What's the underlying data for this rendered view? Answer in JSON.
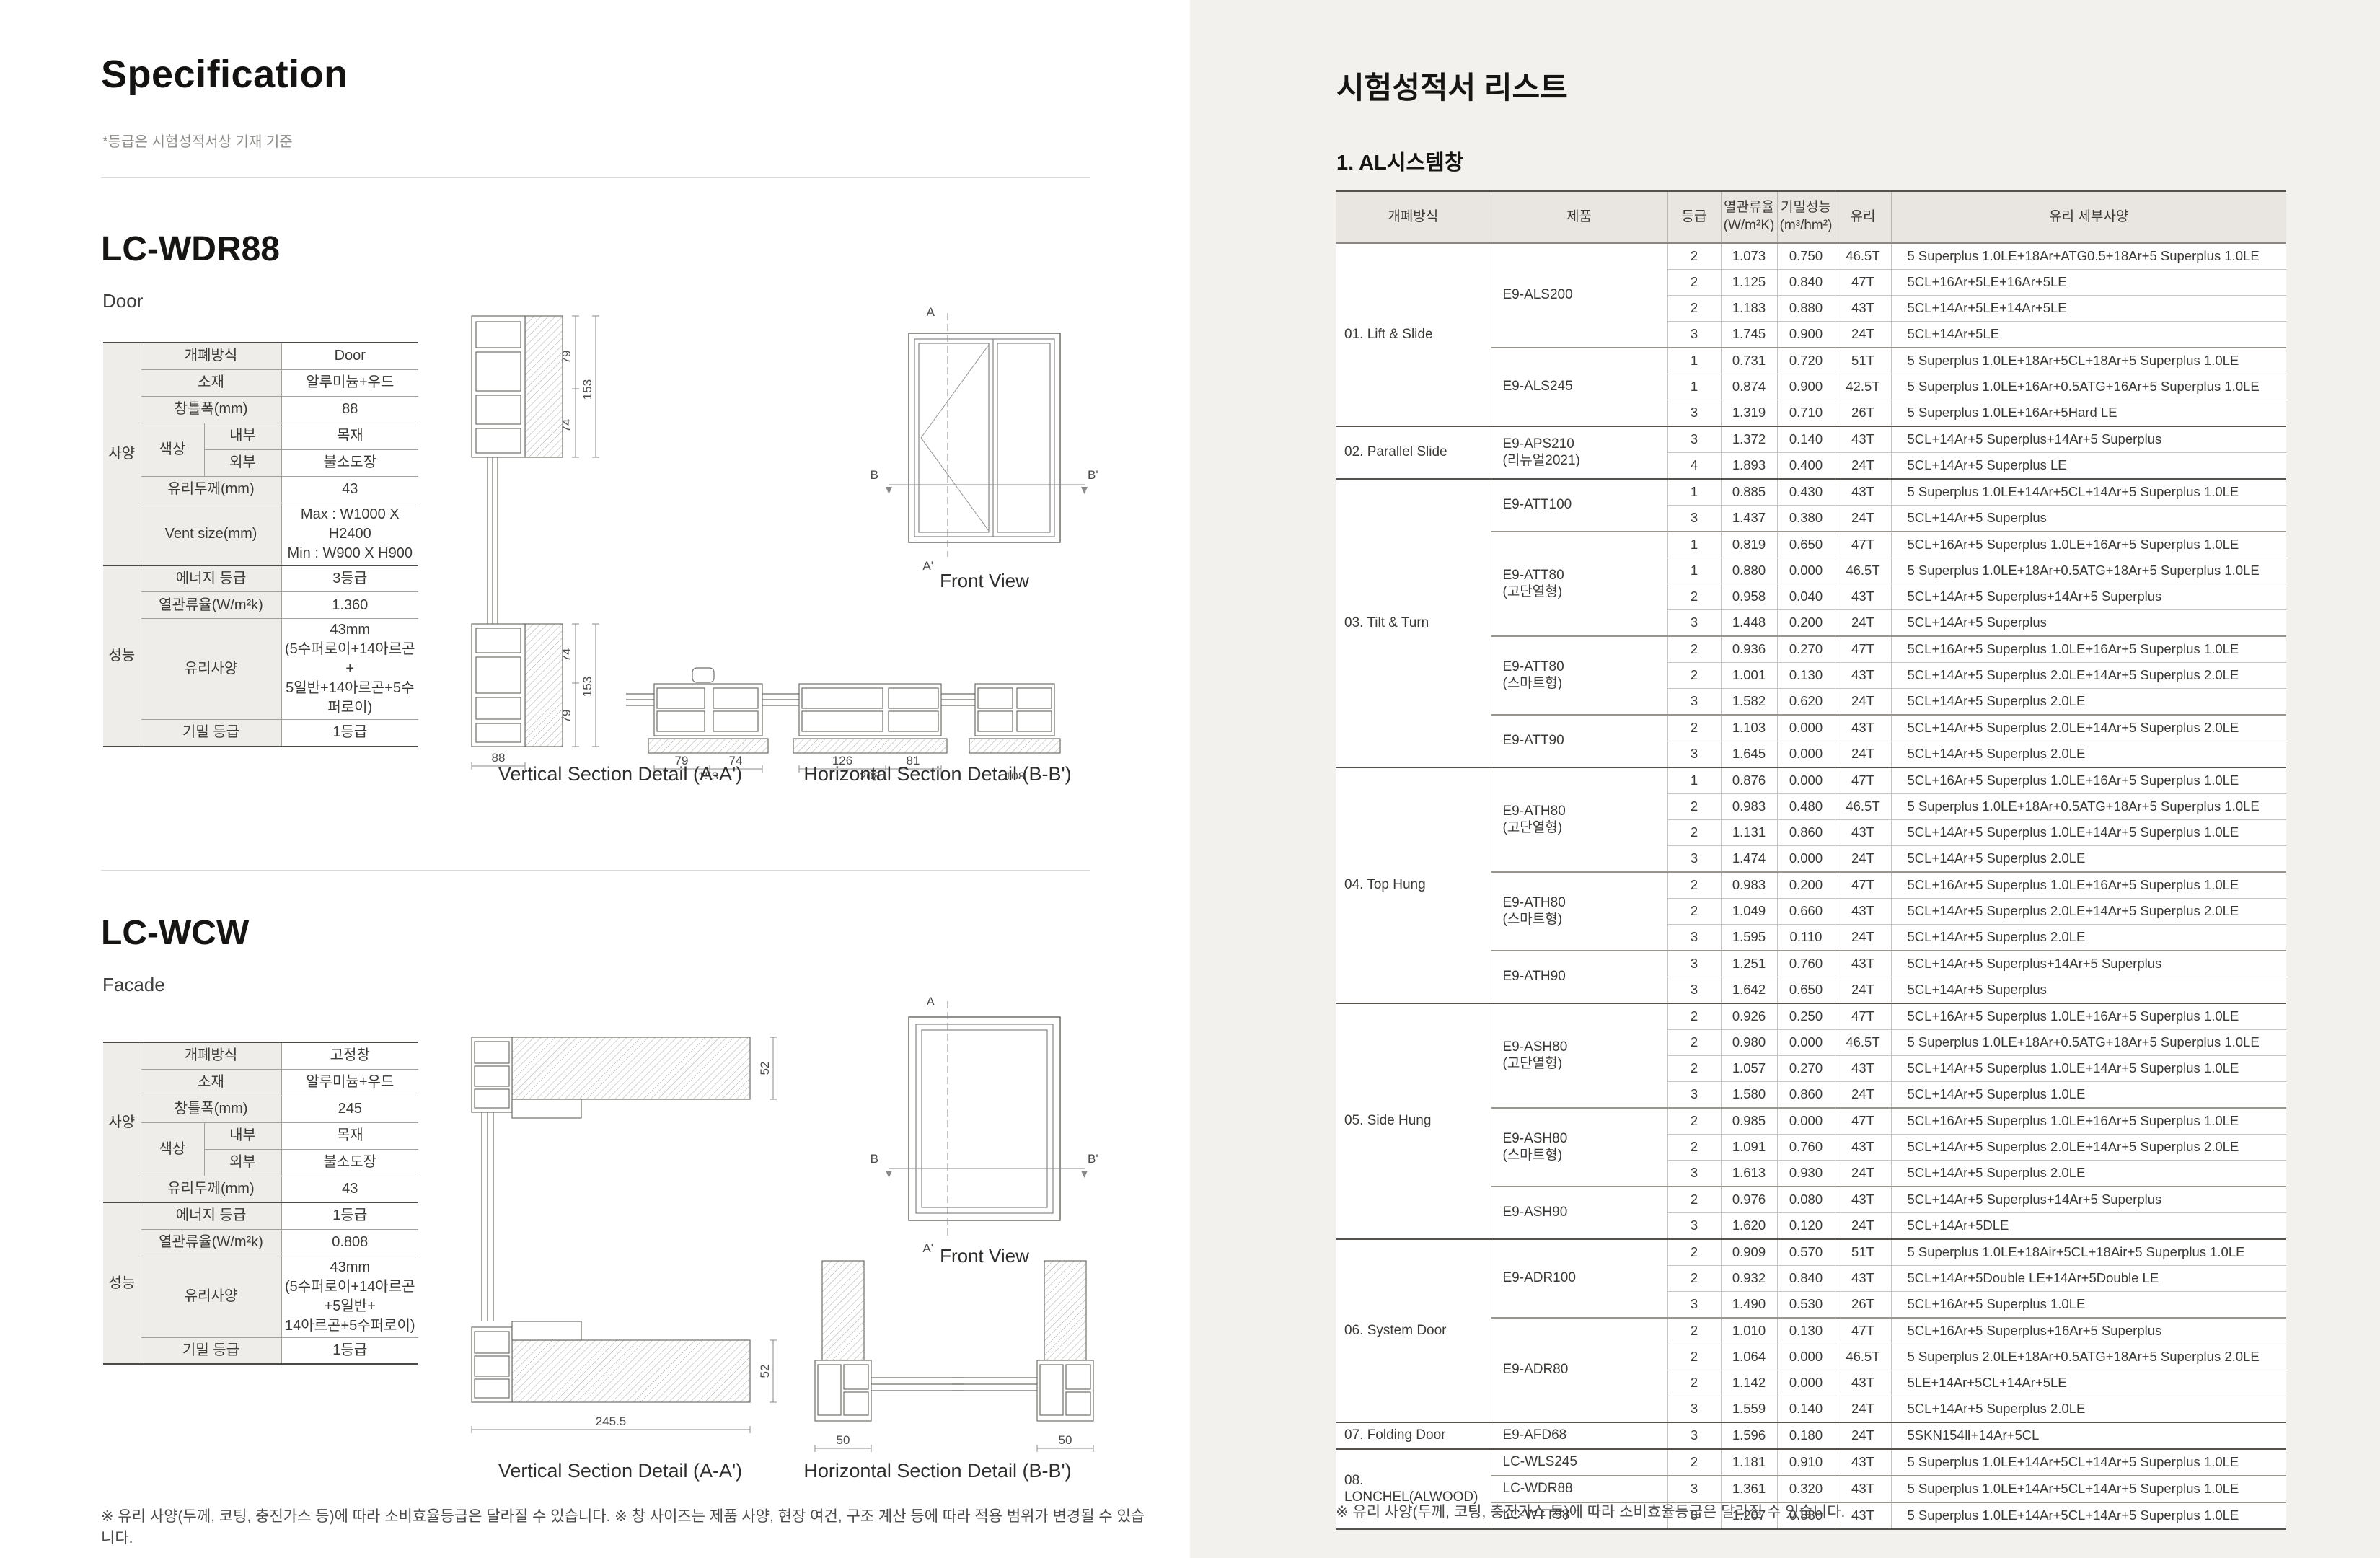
{
  "colors": {
    "right_panel_bg": "#f2f1ed",
    "table_header_bg": "#e9e6e2",
    "label_cell_bg": "#efedea"
  },
  "left": {
    "title": "Specification",
    "note": "*등급은 시험성적서상 기재 기준",
    "footnote": "※ 유리 사양(두께, 코팅, 충진가스 등)에 따라 소비효율등급은 달라질 수 있습니다.  ※ 창 사이즈는 제품 사양, 현장 여건, 구조 계산 등에 따라 적용 범위가 변경될 수 있습니다.",
    "products": [
      {
        "model": "LC-WDR88",
        "type": "Door",
        "spec": {
          "groups": [
            {
              "name": "사양",
              "rows": [
                {
                  "label": "개폐방식",
                  "value": "Door"
                },
                {
                  "label": "소재",
                  "value": "알루미늄+우드"
                },
                {
                  "label": "창틀폭(mm)",
                  "value": "88"
                },
                {
                  "label": "색상",
                  "subrows": [
                    {
                      "sub": "내부",
                      "value": "목재"
                    },
                    {
                      "sub": "외부",
                      "value": "불소도장"
                    }
                  ]
                },
                {
                  "label": "유리두께(mm)",
                  "value": "43"
                },
                {
                  "label": "Vent size(mm)",
                  "value_lines": [
                    "Max : W1000 X H2400",
                    "Min : W900 X H900"
                  ]
                }
              ]
            },
            {
              "name": "성능",
              "rows": [
                {
                  "label": "에너지 등급",
                  "value": "3등급"
                },
                {
                  "label": "열관류율(W/m²k)",
                  "value": "1.360"
                },
                {
                  "label": "유리사양",
                  "value_lines": [
                    "43mm",
                    "(5수퍼로이+14아르곤+",
                    "5일반+14아르곤+5수퍼로이)"
                  ]
                },
                {
                  "label": "기밀 등급",
                  "value": "1등급"
                }
              ]
            }
          ]
        },
        "drawings": {
          "vertical_caption": "Vertical Section Detail (A-A')",
          "horizontal_caption": "Horizontal Section Detail (B-B')",
          "front_caption": "Front View",
          "axis_labels": [
            "A",
            "A'",
            "B",
            "B'"
          ],
          "v_top_dims": [
            "79",
            "74",
            "153"
          ],
          "v_bottom_dims": [
            "74",
            "79",
            "153",
            "88"
          ],
          "h_dims": [
            [
              "79",
              "74",
              "153"
            ],
            [
              "126",
              "81",
              "208"
            ],
            [
              "108"
            ]
          ]
        }
      },
      {
        "model": "LC-WCW",
        "type": "Facade",
        "spec": {
          "groups": [
            {
              "name": "사양",
              "rows": [
                {
                  "label": "개폐방식",
                  "value": "고정창"
                },
                {
                  "label": "소재",
                  "value": "알루미늄+우드"
                },
                {
                  "label": "창틀폭(mm)",
                  "value": "245"
                },
                {
                  "label": "색상",
                  "subrows": [
                    {
                      "sub": "내부",
                      "value": "목재"
                    },
                    {
                      "sub": "외부",
                      "value": "불소도장"
                    }
                  ]
                },
                {
                  "label": "유리두께(mm)",
                  "value": "43"
                }
              ]
            },
            {
              "name": "성능",
              "rows": [
                {
                  "label": "에너지 등급",
                  "value": "1등급"
                },
                {
                  "label": "열관류율(W/m²k)",
                  "value": "0.808"
                },
                {
                  "label": "유리사양",
                  "value_lines": [
                    "43mm",
                    "(5수퍼로이+14아르곤+5일반+",
                    "14아르곤+5수퍼로이)"
                  ]
                },
                {
                  "label": "기밀 등급",
                  "value": "1등급"
                }
              ]
            }
          ]
        },
        "drawings": {
          "vertical_caption": "Vertical Section Detail (A-A')",
          "horizontal_caption": "Horizontal Section Detail (B-B')",
          "front_caption": "Front View",
          "axis_labels": [
            "A",
            "A'",
            "B",
            "B'"
          ],
          "v_top_dims": [
            "52"
          ],
          "v_bottom_dims": [
            "52",
            "245.5"
          ],
          "h_dims": [
            [
              "50"
            ],
            [
              "50"
            ]
          ]
        }
      }
    ]
  },
  "right": {
    "title": "시험성적서 리스트",
    "section": "1. AL시스템창",
    "footnote": "※ 유리 사양(두께, 코팅, 충진가스 등)에 따라 소비효율등급은 달라질 수 있습니다.",
    "table": {
      "headers": [
        "개폐방식",
        "제품",
        "등급",
        "열관류율\n(W/m²K)",
        "기밀성능\n(m³/hm²)",
        "유리",
        "유리 세부사양"
      ],
      "groups": [
        {
          "name": "01. Lift & Slide",
          "products": [
            {
              "name": "E9-ALS200",
              "rows": [
                [
                  "2",
                  "1.073",
                  "0.750",
                  "46.5T",
                  "5 Superplus 1.0LE+18Ar+ATG0.5+18Ar+5 Superplus 1.0LE"
                ],
                [
                  "2",
                  "1.125",
                  "0.840",
                  "47T",
                  "5CL+16Ar+5LE+16Ar+5LE"
                ],
                [
                  "2",
                  "1.183",
                  "0.880",
                  "43T",
                  "5CL+14Ar+5LE+14Ar+5LE"
                ],
                [
                  "3",
                  "1.745",
                  "0.900",
                  "24T",
                  "5CL+14Ar+5LE"
                ]
              ]
            },
            {
              "name": "E9-ALS245",
              "rows": [
                [
                  "1",
                  "0.731",
                  "0.720",
                  "51T",
                  "5 Superplus 1.0LE+18Ar+5CL+18Ar+5 Superplus 1.0LE"
                ],
                [
                  "1",
                  "0.874",
                  "0.900",
                  "42.5T",
                  "5 Superplus 1.0LE+16Ar+0.5ATG+16Ar+5 Superplus 1.0LE"
                ],
                [
                  "3",
                  "1.319",
                  "0.710",
                  "26T",
                  "5 Superplus 1.0LE+16Ar+5Hard LE"
                ]
              ]
            }
          ]
        },
        {
          "name": "02. Parallel Slide",
          "products": [
            {
              "name": "E9-APS210",
              "name2": "(리뉴얼2021)",
              "rows": [
                [
                  "3",
                  "1.372",
                  "0.140",
                  "43T",
                  "5CL+14Ar+5 Superplus+14Ar+5 Superplus"
                ],
                [
                  "4",
                  "1.893",
                  "0.400",
                  "24T",
                  "5CL+14Ar+5 Superplus LE"
                ]
              ]
            }
          ]
        },
        {
          "name": "03. Tilt & Turn",
          "products": [
            {
              "name": "E9-ATT100",
              "rows": [
                [
                  "1",
                  "0.885",
                  "0.430",
                  "43T",
                  "5 Superplus 1.0LE+14Ar+5CL+14Ar+5 Superplus 1.0LE"
                ],
                [
                  "3",
                  "1.437",
                  "0.380",
                  "24T",
                  "5CL+14Ar+5 Superplus"
                ]
              ]
            },
            {
              "name": "E9-ATT80",
              "name2": "(고단열형)",
              "rows": [
                [
                  "1",
                  "0.819",
                  "0.650",
                  "47T",
                  "5CL+16Ar+5 Superplus 1.0LE+16Ar+5 Superplus 1.0LE"
                ],
                [
                  "1",
                  "0.880",
                  "0.000",
                  "46.5T",
                  "5 Superplus 1.0LE+18Ar+0.5ATG+18Ar+5 Superplus 1.0LE"
                ],
                [
                  "2",
                  "0.958",
                  "0.040",
                  "43T",
                  "5CL+14Ar+5 Superplus+14Ar+5 Superplus"
                ],
                [
                  "3",
                  "1.448",
                  "0.200",
                  "24T",
                  "5CL+14Ar+5 Superplus"
                ]
              ]
            },
            {
              "name": "E9-ATT80",
              "name2": "(스마트형)",
              "rows": [
                [
                  "2",
                  "0.936",
                  "0.270",
                  "47T",
                  "5CL+16Ar+5 Superplus 1.0LE+16Ar+5 Superplus 1.0LE"
                ],
                [
                  "2",
                  "1.001",
                  "0.130",
                  "43T",
                  "5CL+14Ar+5 Superplus 2.0LE+14Ar+5 Superplus 2.0LE"
                ],
                [
                  "3",
                  "1.582",
                  "0.620",
                  "24T",
                  "5CL+14Ar+5 Superplus 2.0LE"
                ]
              ]
            },
            {
              "name": "E9-ATT90",
              "rows": [
                [
                  "2",
                  "1.103",
                  "0.000",
                  "43T",
                  "5CL+14Ar+5 Superplus 2.0LE+14Ar+5 Superplus 2.0LE"
                ],
                [
                  "3",
                  "1.645",
                  "0.000",
                  "24T",
                  "5CL+14Ar+5 Superplus 2.0LE"
                ]
              ]
            }
          ]
        },
        {
          "name": "04. Top Hung",
          "products": [
            {
              "name": "E9-ATH80",
              "name2": "(고단열형)",
              "rows": [
                [
                  "1",
                  "0.876",
                  "0.000",
                  "47T",
                  "5CL+16Ar+5 Superplus 1.0LE+16Ar+5 Superplus 1.0LE"
                ],
                [
                  "2",
                  "0.983",
                  "0.480",
                  "46.5T",
                  "5 Superplus 1.0LE+18Ar+0.5ATG+18Ar+5 Superplus 1.0LE"
                ],
                [
                  "2",
                  "1.131",
                  "0.860",
                  "43T",
                  "5CL+14Ar+5 Superplus 1.0LE+14Ar+5 Superplus 1.0LE"
                ],
                [
                  "3",
                  "1.474",
                  "0.000",
                  "24T",
                  "5CL+14Ar+5 Superplus 2.0LE"
                ]
              ]
            },
            {
              "name": "E9-ATH80",
              "name2": "(스마트형)",
              "rows": [
                [
                  "2",
                  "0.983",
                  "0.200",
                  "47T",
                  "5CL+16Ar+5 Superplus 1.0LE+16Ar+5 Superplus 1.0LE"
                ],
                [
                  "2",
                  "1.049",
                  "0.660",
                  "43T",
                  "5CL+14Ar+5 Superplus 2.0LE+14Ar+5 Superplus 2.0LE"
                ],
                [
                  "3",
                  "1.595",
                  "0.110",
                  "24T",
                  "5CL+14Ar+5 Superplus 2.0LE"
                ]
              ]
            },
            {
              "name": "E9-ATH90",
              "rows": [
                [
                  "3",
                  "1.251",
                  "0.760",
                  "43T",
                  "5CL+14Ar+5 Superplus+14Ar+5 Superplus"
                ],
                [
                  "3",
                  "1.642",
                  "0.650",
                  "24T",
                  "5CL+14Ar+5 Superplus"
                ]
              ]
            }
          ]
        },
        {
          "name": "05. Side Hung",
          "products": [
            {
              "name": "E9-ASH80",
              "name2": "(고단열형)",
              "rows": [
                [
                  "2",
                  "0.926",
                  "0.250",
                  "47T",
                  "5CL+16Ar+5 Superplus 1.0LE+16Ar+5 Superplus 1.0LE"
                ],
                [
                  "2",
                  "0.980",
                  "0.000",
                  "46.5T",
                  "5 Superplus 1.0LE+18Ar+0.5ATG+18Ar+5 Superplus 1.0LE"
                ],
                [
                  "2",
                  "1.057",
                  "0.270",
                  "43T",
                  "5CL+14Ar+5 Superplus 1.0LE+14Ar+5 Superplus 1.0LE"
                ],
                [
                  "3",
                  "1.580",
                  "0.860",
                  "24T",
                  "5CL+14Ar+5 Superplus 1.0LE"
                ]
              ]
            },
            {
              "name": "E9-ASH80",
              "name2": "(스마트형)",
              "rows": [
                [
                  "2",
                  "0.985",
                  "0.000",
                  "47T",
                  "5CL+16Ar+5 Superplus 1.0LE+16Ar+5 Superplus 1.0LE"
                ],
                [
                  "2",
                  "1.091",
                  "0.760",
                  "43T",
                  "5CL+14Ar+5 Superplus 2.0LE+14Ar+5 Superplus 2.0LE"
                ],
                [
                  "3",
                  "1.613",
                  "0.930",
                  "24T",
                  "5CL+14Ar+5 Superplus 2.0LE"
                ]
              ]
            },
            {
              "name": "E9-ASH90",
              "rows": [
                [
                  "2",
                  "0.976",
                  "0.080",
                  "43T",
                  "5CL+14Ar+5 Superplus+14Ar+5 Superplus"
                ],
                [
                  "3",
                  "1.620",
                  "0.120",
                  "24T",
                  "5CL+14Ar+5DLE"
                ]
              ]
            }
          ]
        },
        {
          "name": "06. System Door",
          "products": [
            {
              "name": "E9-ADR100",
              "rows": [
                [
                  "2",
                  "0.909",
                  "0.570",
                  "51T",
                  "5 Superplus 1.0LE+18Air+5CL+18Air+5 Superplus 1.0LE"
                ],
                [
                  "2",
                  "0.932",
                  "0.840",
                  "43T",
                  "5CL+14Ar+5Double LE+14Ar+5Double LE"
                ],
                [
                  "3",
                  "1.490",
                  "0.530",
                  "26T",
                  "5CL+16Ar+5 Superplus 1.0LE"
                ]
              ]
            },
            {
              "name": "E9-ADR80",
              "rows": [
                [
                  "2",
                  "1.010",
                  "0.130",
                  "47T",
                  "5CL+16Ar+5 Superplus+16Ar+5 Superplus"
                ],
                [
                  "2",
                  "1.064",
                  "0.000",
                  "46.5T",
                  "5 Superplus 2.0LE+18Ar+0.5ATG+18Ar+5 Superplus 2.0LE"
                ],
                [
                  "2",
                  "1.142",
                  "0.000",
                  "43T",
                  "5LE+14Ar+5CL+14Ar+5LE"
                ],
                [
                  "3",
                  "1.559",
                  "0.140",
                  "24T",
                  "5CL+14Ar+5 Superplus 2.0LE"
                ]
              ]
            }
          ]
        },
        {
          "name": "07. Folding Door",
          "products": [
            {
              "name": "E9-AFD68",
              "rows": [
                [
                  "3",
                  "1.596",
                  "0.180",
                  "24T",
                  "5SKN154Ⅱ+14Ar+5CL"
                ]
              ]
            }
          ]
        },
        {
          "name": "08. LONCHEL(ALWOOD)",
          "products": [
            {
              "name": "LC-WLS245",
              "rows": [
                [
                  "2",
                  "1.181",
                  "0.910",
                  "43T",
                  "5 Superplus 1.0LE+14Ar+5CL+14Ar+5 Superplus 1.0LE"
                ]
              ]
            },
            {
              "name": "LC-WDR88",
              "rows": [
                [
                  "3",
                  "1.361",
                  "0.320",
                  "43T",
                  "5 Superplus 1.0LE+14Ar+5CL+14Ar+5 Superplus 1.0LE"
                ]
              ]
            },
            {
              "name": "LC-WTT98",
              "rows": [
                [
                  "3",
                  "1.207",
                  "0.880",
                  "43T",
                  "5 Superplus 1.0LE+14Ar+5CL+14Ar+5 Superplus 1.0LE"
                ]
              ]
            }
          ]
        }
      ]
    }
  }
}
